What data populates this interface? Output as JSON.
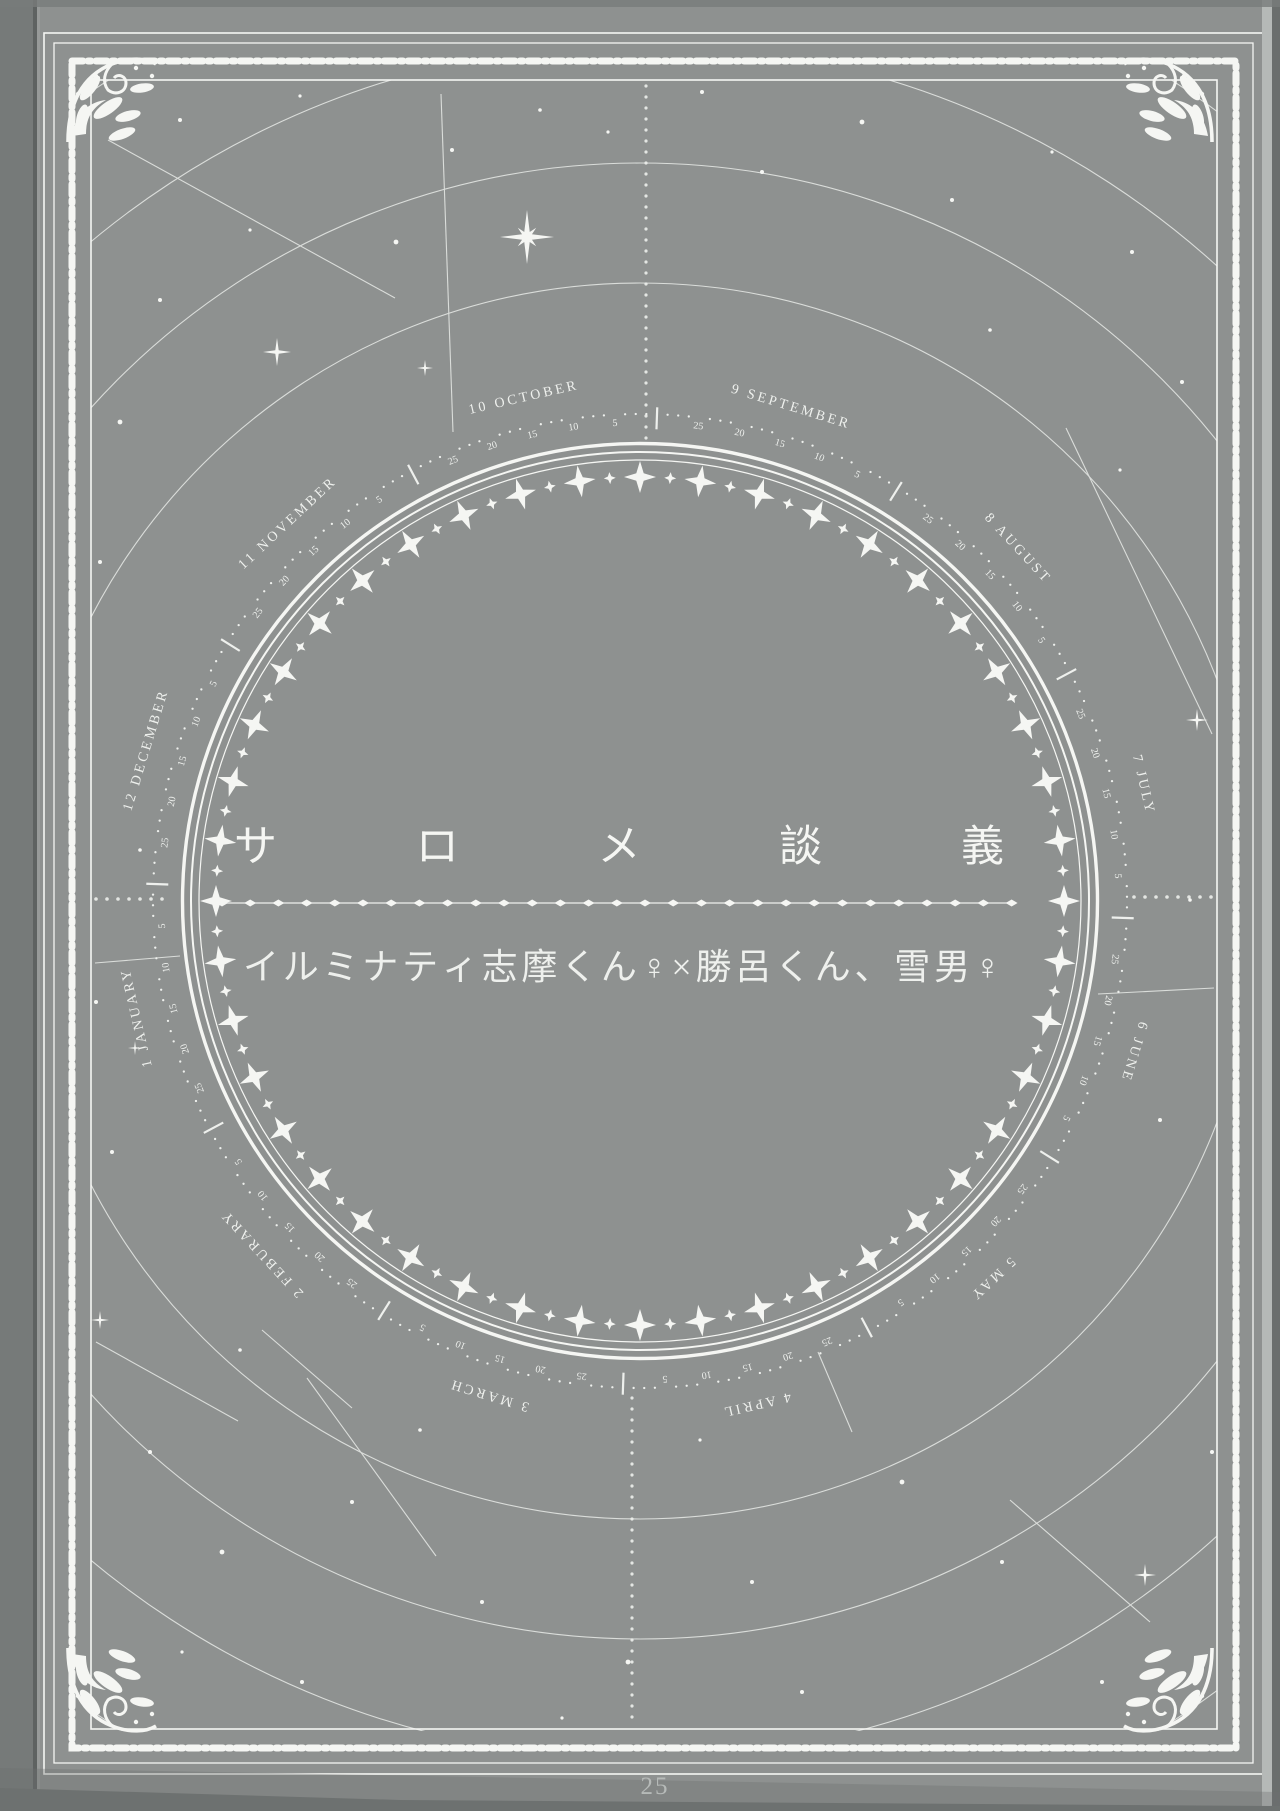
{
  "page": {
    "title": "サロメ談義",
    "subtitle": "イルミナティ志摩くん♀×勝呂くん、雪男♀",
    "page_number": "25",
    "colors": {
      "paper": "#8e9190",
      "ink": "#eef0ed",
      "ink_bright": "#f5f6f3",
      "muted": "#b6bab8",
      "edge_dark": "#6d7170",
      "edge_light": "#b5b9b7"
    }
  },
  "calendar_ring": {
    "months": [
      "1 JANUARY",
      "2 FEBURARY",
      "3 MARCH",
      "4 APRIL",
      "5 MAY",
      "6 JUNE",
      "7 JULY",
      "8 AUGUST",
      "9 SEPTEMBER",
      "10 OCTOBER",
      "11 NOVEMBER",
      "12 DECEMBER"
    ],
    "day_ticks": [
      "25",
      "20",
      "15",
      "10",
      "5"
    ]
  }
}
